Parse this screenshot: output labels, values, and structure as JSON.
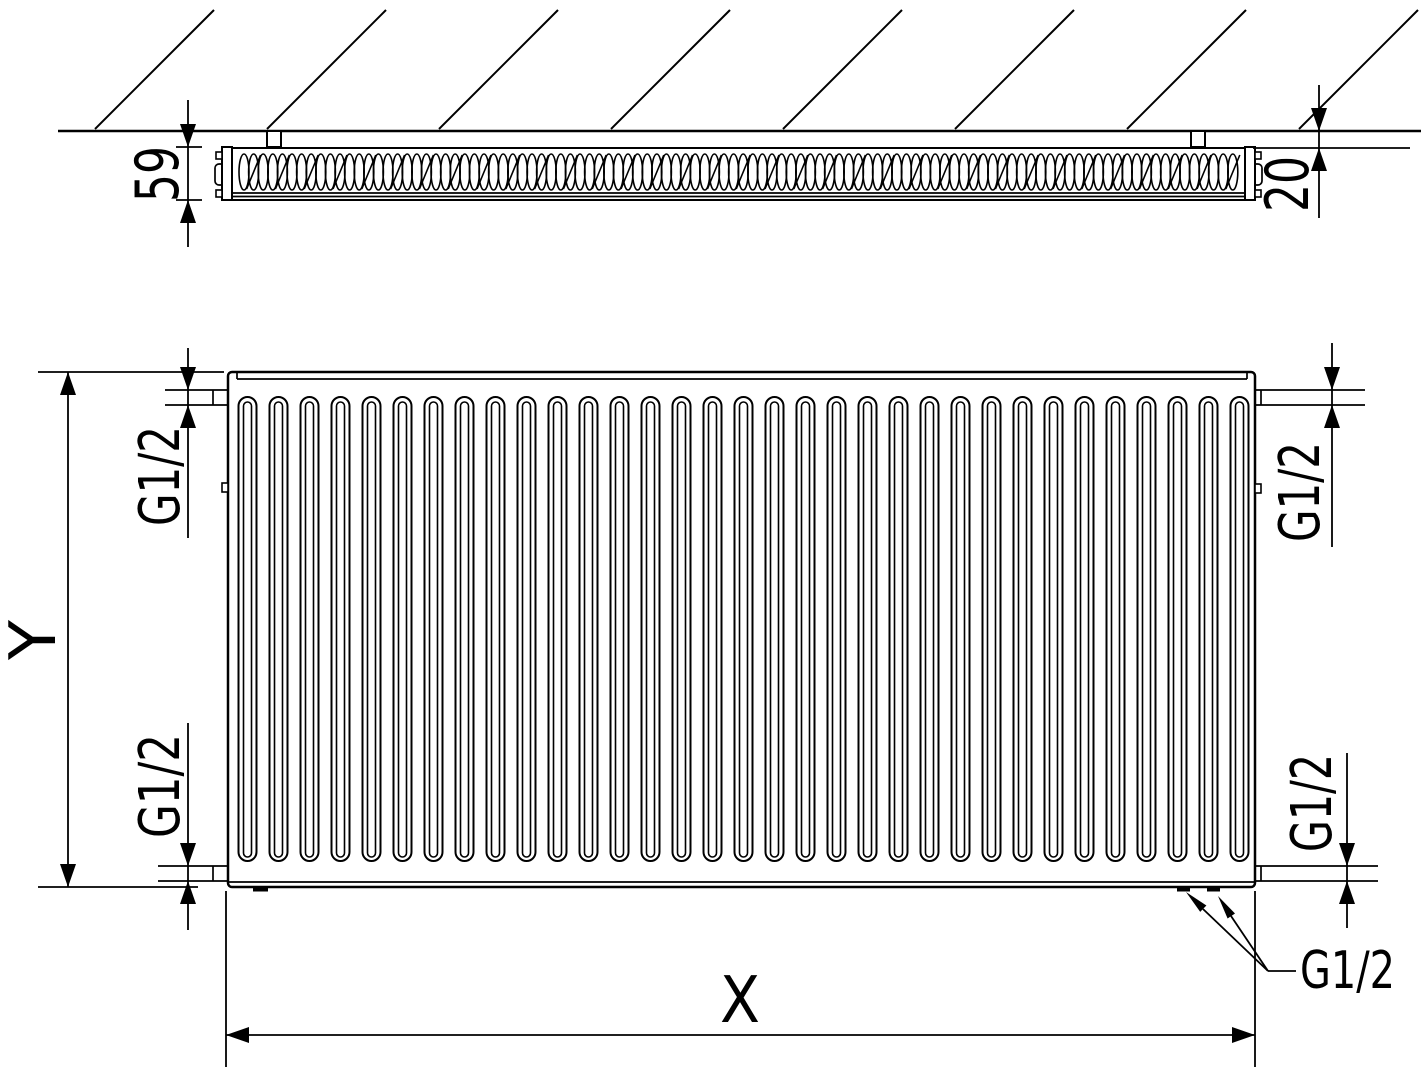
{
  "colors": {
    "ink": "#000000",
    "paper": "#ffffff"
  },
  "labels": {
    "depth": "59",
    "wall_distance": "20",
    "height": "Y",
    "length": "X",
    "conn_top_left": "G1/2",
    "conn_top_right": "G1/2",
    "conn_bottom_left": "G1/2",
    "conn_bottom_right": "G1/2",
    "conn_bottom_valves": "G1/2"
  },
  "geometry": {
    "hatch": {
      "count": 8,
      "x0": 95,
      "spacing": 172,
      "y": 129,
      "rise": 119
    },
    "corrugation": {
      "x0": 244,
      "x1": 1234,
      "pitch": 9.6,
      "cy": 172,
      "rx": 5,
      "ry": 18,
      "slant_every": 3
    },
    "channels": {
      "count": 33,
      "x0": 238.5,
      "pitch": 31,
      "top": 397,
      "bottom": 861,
      "outer_width": 18,
      "outer_radius": 9,
      "inner_inset": 5,
      "inner_width": 8,
      "inner_radius": 4,
      "inner_top": 402,
      "inner_bottom": 857
    }
  }
}
